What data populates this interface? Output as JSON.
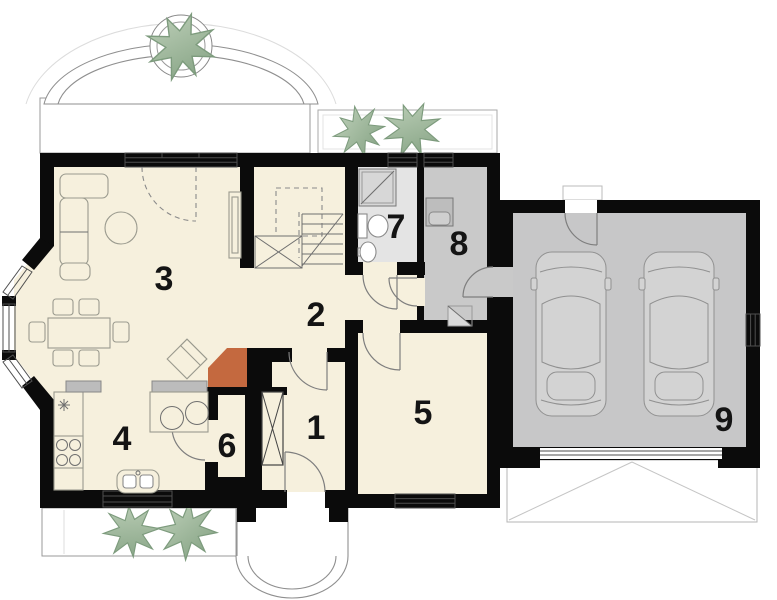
{
  "rooms": [
    {
      "number": "1"
    },
    {
      "number": "2"
    },
    {
      "number": "3"
    },
    {
      "number": "4"
    },
    {
      "number": "5"
    },
    {
      "number": "6"
    },
    {
      "number": "7"
    },
    {
      "number": "8"
    },
    {
      "number": "9"
    }
  ],
  "colors": {
    "wall": "#0b0b0b",
    "floor_main": "#f6f0dd",
    "floor_bathroom": "#e4e4e4",
    "floor_utility": "#c9c9c9",
    "floor_garage": "#c7c7c8",
    "fireplace_accent": "#c4693f",
    "tree_green": "#8fae8c",
    "car_body": "#d3d3d3",
    "countertop": "#bcbcbc",
    "outline_gray": "#999999"
  }
}
